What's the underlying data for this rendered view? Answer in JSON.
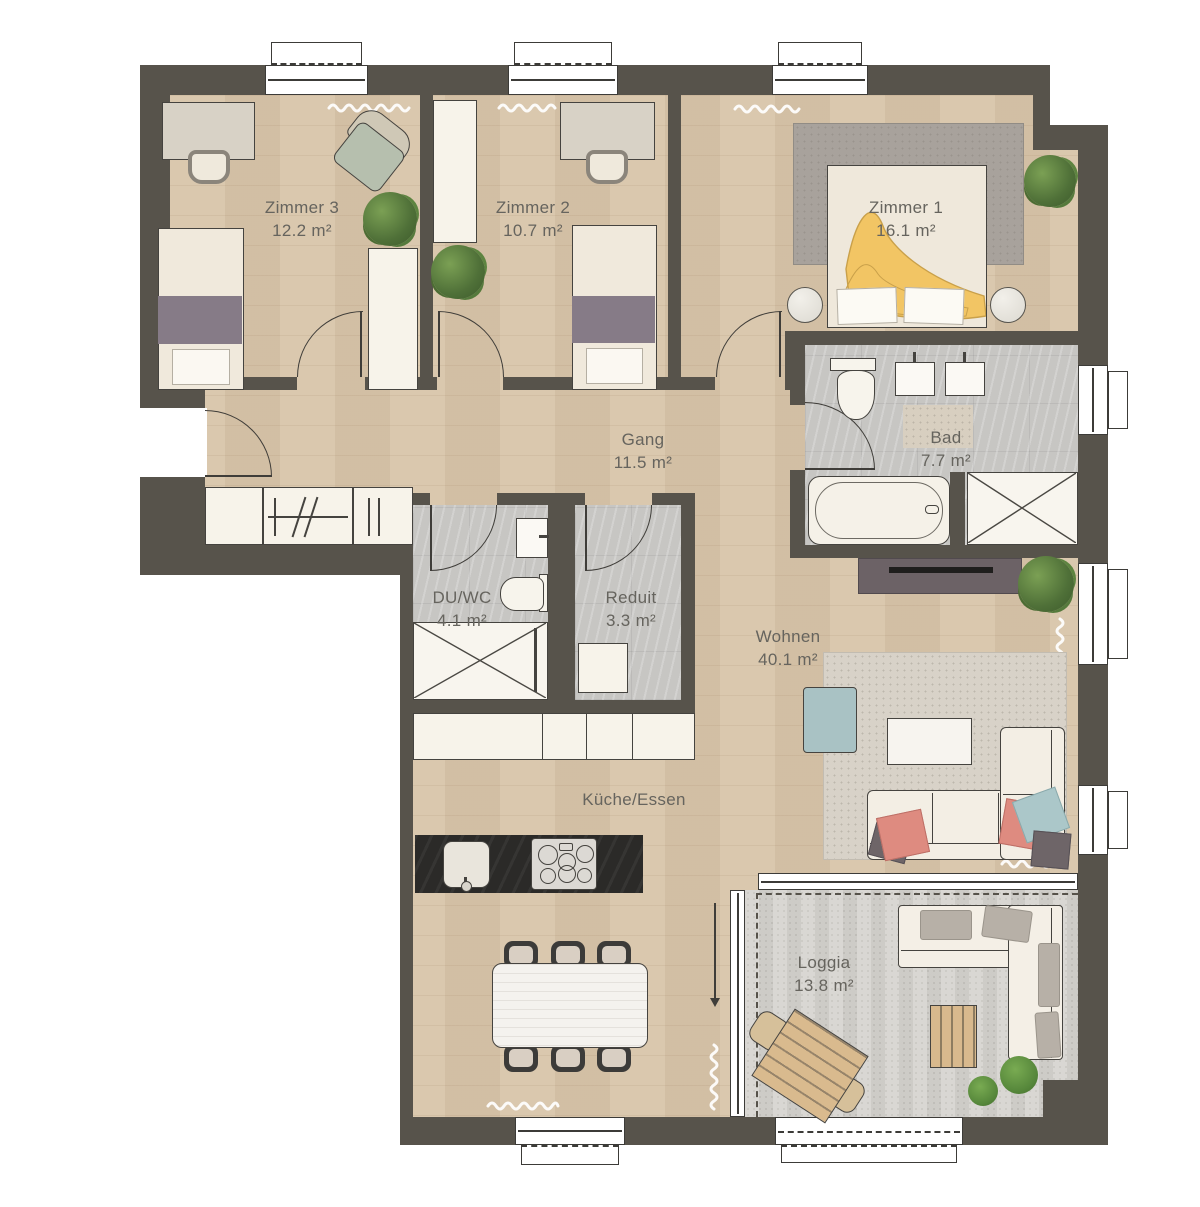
{
  "plan": {
    "rooms": [
      {
        "name": "Zimmer 3",
        "area": "12.2 m²"
      },
      {
        "name": "Zimmer 2",
        "area": "10.7 m²"
      },
      {
        "name": "Zimmer 1",
        "area": "16.1 m²"
      },
      {
        "name": "Gang",
        "area": "11.5 m²"
      },
      {
        "name": "Bad",
        "area": "7.7 m²"
      },
      {
        "name": "DU/WC",
        "area": "4.1 m²"
      },
      {
        "name": "Reduit",
        "area": "3.3 m²"
      },
      {
        "name": "Wohnen",
        "area": "40.1 m²"
      },
      {
        "name": "Küche/Essen",
        "area": ""
      },
      {
        "name": "Loggia",
        "area": "13.8 m²"
      }
    ],
    "colors": {
      "wall": "#57534b",
      "wood_floor": "#d8c5aa",
      "tile_floor": "#c7c6c3",
      "concrete_floor": "#d4d2cd",
      "label_text": "#66645e",
      "accent_yellow": "#f2c564",
      "accent_pink": "#de8b80",
      "accent_blue": "#abc7c9",
      "accent_purple": "#867b87"
    }
  }
}
